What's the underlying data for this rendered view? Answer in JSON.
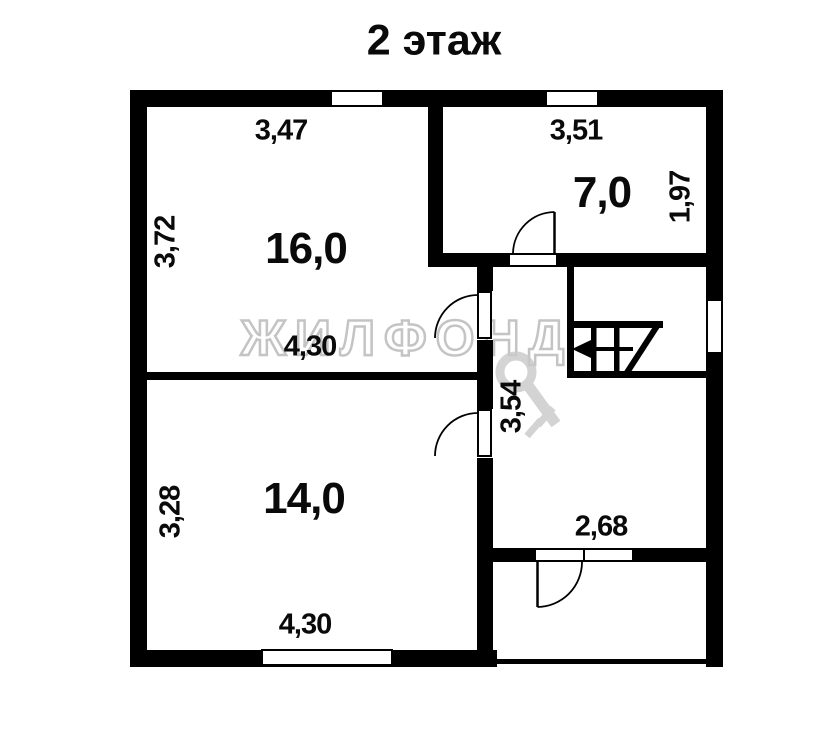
{
  "title": "2 этаж",
  "watermark": "ЖИЛФОНД",
  "rooms": {
    "room16": {
      "area": "16,0",
      "width_top": "3,47",
      "height_left": "3,72",
      "width_bottom": "4,30"
    },
    "room7": {
      "area": "7,0",
      "width_top": "3,51",
      "height_right": "1,97"
    },
    "room14": {
      "area": "14,0",
      "height_left": "3,28",
      "width_bottom": "4,30"
    },
    "hall": {
      "depth": "3,54"
    },
    "balcony": {
      "width": "2,68"
    }
  },
  "colors": {
    "wall": "#000000",
    "background": "#ffffff",
    "watermark": "#c4c4c4"
  }
}
